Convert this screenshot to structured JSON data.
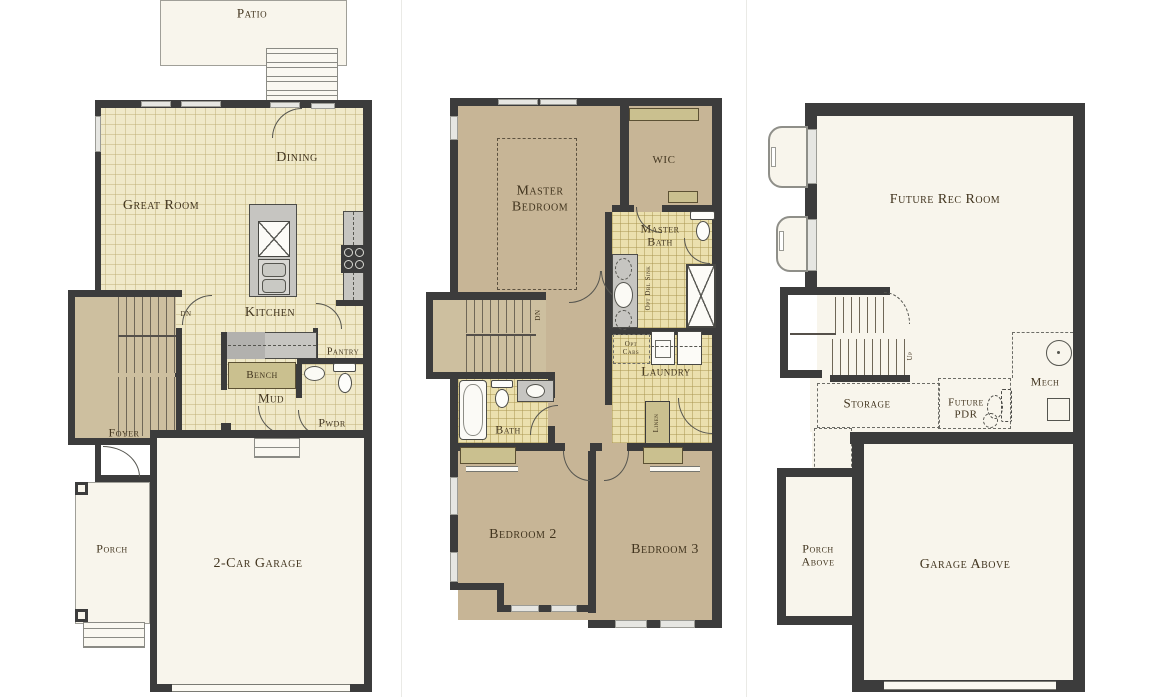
{
  "palette": {
    "wall": "#3c3c3c",
    "tile_floor": "#f0e9c9",
    "bath_tile": "#ebe0ae",
    "carpet": "#c7b596",
    "stair_carpet": "#cdbf9f",
    "open_floor": "#f8f5ec",
    "shelf_olive": "#cac08f",
    "counter_gray": "#c6c5c1",
    "label_text": "#42351f"
  },
  "plans": {
    "main": {
      "title": "Main Level",
      "labels": {
        "patio": "Patio",
        "dining": "Dining",
        "great_room": "Great Room",
        "kitchen": "Kitchen",
        "dn": "DN",
        "pantry": "Pantry",
        "bench": "Bench",
        "mud": "Mud",
        "pwdr": "Pwdr",
        "foyer": "Foyer",
        "porch": "Porch",
        "garage": "2-Car Garage"
      }
    },
    "upper": {
      "title": "Upper Level",
      "labels": {
        "master_bedroom": "Master\nBedroom",
        "wic": "WIC",
        "master_bath": "Master\nBath",
        "opt_dbl_sink": "Opt Dbl Sink",
        "dn": "DN",
        "opt_cabs": "Opt\nCabs",
        "laundry": "Laundry",
        "linen": "Linen",
        "bath": "Bath",
        "bedroom2": "Bedroom 2",
        "bedroom3": "Bedroom 3"
      }
    },
    "basement": {
      "title": "Basement",
      "labels": {
        "future_rec_room": "Future Rec Room",
        "up": "Up",
        "storage": "Storage",
        "future_pdr": "Future\nPDR",
        "mech": "Mech",
        "porch_above": "Porch\nAbove",
        "garage_above": "Garage Above"
      }
    }
  }
}
